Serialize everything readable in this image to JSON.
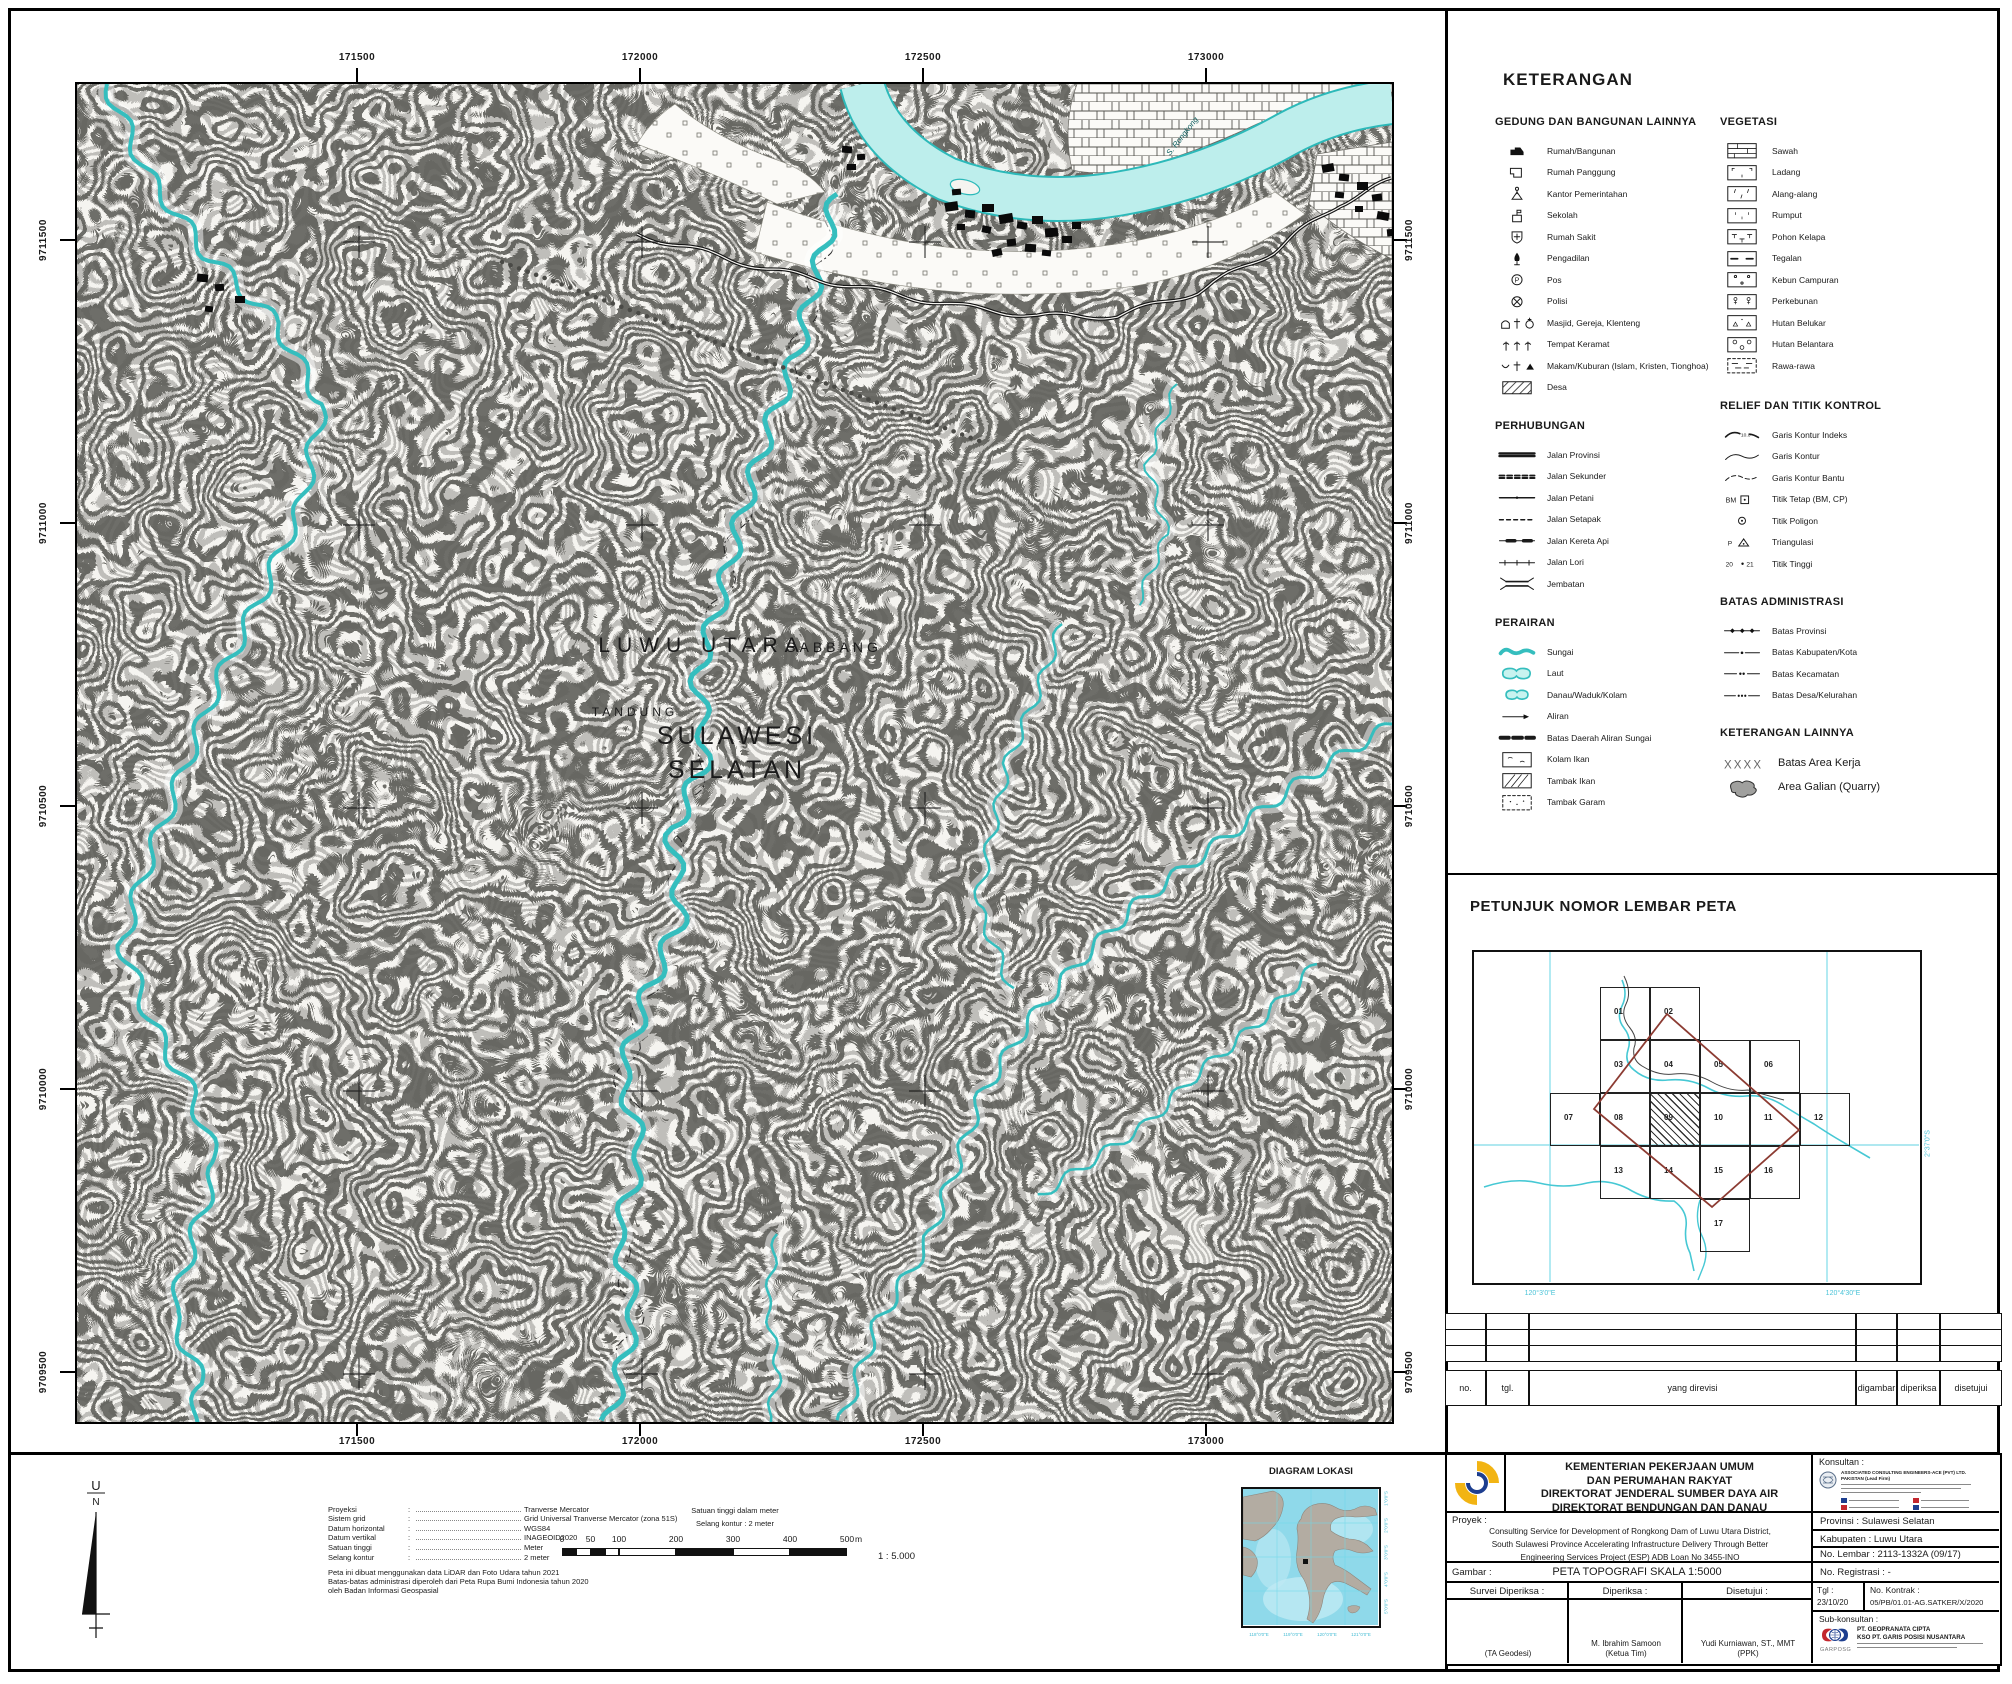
{
  "colors": {
    "water": "#35bebe",
    "water_fill": "#bdeeec",
    "cyan_label": "#4cc4d8",
    "diamond": "#8c3b32",
    "logo_yellow": "#f2b413",
    "logo_blue": "#1d3e8f",
    "logo_red": "#c3272e"
  },
  "map": {
    "top_labels": [
      "171500",
      "172000",
      "172500",
      "173000"
    ],
    "bottom_labels": [
      "171500",
      "172000",
      "172500",
      "173000"
    ],
    "left_labels": [
      "9711500",
      "9711000",
      "9710500",
      "9710000",
      "9709500"
    ],
    "right_labels": [
      "9711500",
      "9711000",
      "9710500",
      "9710000",
      "9709500"
    ],
    "place_labels": {
      "region_top": "LUWU UTARA",
      "village": "SABBANG",
      "village2": "TANDUNG",
      "region_main_1": "SULAWESI",
      "region_main_2": "SELATAN",
      "river_name": "S. Rongkong"
    }
  },
  "legend": {
    "title": "KETERANGAN",
    "sections": [
      {
        "title": "GEDUNG DAN BANGUNAN LAINNYA",
        "items": [
          {
            "label": "Rumah/Bangunan",
            "sym": "house",
            "icon": "house-icon"
          },
          {
            "label": "Rumah Panggung",
            "sym": "stilt",
            "icon": "stilt-house-icon"
          },
          {
            "label": "Kantor Pemerintahan",
            "sym": "office",
            "icon": "government-office-icon"
          },
          {
            "label": "Sekolah",
            "sym": "school",
            "icon": "school-icon"
          },
          {
            "label": "Rumah Sakit",
            "sym": "hospital",
            "icon": "hospital-icon"
          },
          {
            "label": "Pengadilan",
            "sym": "court",
            "icon": "courthouse-icon"
          },
          {
            "label": "Pos",
            "sym": "post",
            "icon": "post-office-icon"
          },
          {
            "label": "Polisi",
            "sym": "police",
            "icon": "police-icon"
          },
          {
            "label": "Masjid, Gereja, Klenteng",
            "sym": "worship",
            "icon": "worship-places-icon"
          },
          {
            "label": "Tempat Keramat",
            "sym": "sacred",
            "icon": "sacred-place-icon"
          },
          {
            "label": "Makam/Kuburan (Islam, Kristen, Tionghoa)",
            "sym": "grave",
            "icon": "cemetery-icon"
          },
          {
            "label": "Desa",
            "sym": "desa",
            "icon": "village-area-icon"
          }
        ]
      },
      {
        "title": "PERHUBUNGAN",
        "items": [
          {
            "label": "Jalan Provinsi",
            "sym": "road-prov",
            "icon": "provincial-road-icon"
          },
          {
            "label": "Jalan Sekunder",
            "sym": "road-sec",
            "icon": "secondary-road-icon"
          },
          {
            "label": "Jalan Petani",
            "sym": "road-farm",
            "icon": "farm-road-icon"
          },
          {
            "label": "Jalan Setapak",
            "sym": "road-path",
            "icon": "footpath-icon"
          },
          {
            "label": "Jalan Kereta Api",
            "sym": "railway",
            "icon": "railway-icon"
          },
          {
            "label": "Jalan Lori",
            "sym": "lori",
            "icon": "lori-track-icon"
          },
          {
            "label": "Jembatan",
            "sym": "bridge",
            "icon": "bridge-icon"
          }
        ]
      },
      {
        "title": "PERAIRAN",
        "items": [
          {
            "label": "Sungai",
            "sym": "river",
            "icon": "river-icon"
          },
          {
            "label": "Laut",
            "sym": "sea",
            "icon": "sea-icon"
          },
          {
            "label": "Danau/Waduk/Kolam",
            "sym": "lake",
            "icon": "lake-icon"
          },
          {
            "label": "Aliran",
            "sym": "flow",
            "icon": "flow-arrow-icon"
          },
          {
            "label": "Batas Daerah Aliran Sungai",
            "sym": "das",
            "icon": "watershed-boundary-icon"
          },
          {
            "label": "Kolam Ikan",
            "sym": "fishpond",
            "icon": "fishpond-icon"
          },
          {
            "label": "Tambak Ikan",
            "sym": "fishfarm",
            "icon": "fish-farm-icon"
          },
          {
            "label": "Tambak Garam",
            "sym": "saltpond",
            "icon": "salt-pond-icon"
          }
        ]
      },
      {
        "title": "VEGETASI",
        "items": [
          {
            "label": "Sawah",
            "sym": "sawah",
            "icon": "ricefield-icon"
          },
          {
            "label": "Ladang",
            "sym": "ladang",
            "icon": "field-icon"
          },
          {
            "label": "Alang-alang",
            "sym": "alang",
            "icon": "reed-grass-icon"
          },
          {
            "label": "Rumput",
            "sym": "rumput",
            "icon": "grass-icon"
          },
          {
            "label": "Pohon Kelapa",
            "sym": "kelapa",
            "icon": "coconut-palm-icon"
          },
          {
            "label": "Tegalan",
            "sym": "tegalan",
            "icon": "dry-field-icon"
          },
          {
            "label": "Kebun Campuran",
            "sym": "kebun",
            "icon": "mixed-garden-icon"
          },
          {
            "label": "Perkebunan",
            "sym": "perkebunan",
            "icon": "plantation-icon"
          },
          {
            "label": "Hutan Belukar",
            "sym": "belukar",
            "icon": "shrub-forest-icon"
          },
          {
            "label": "Hutan Belantara",
            "sym": "belantara",
            "icon": "wild-forest-icon"
          },
          {
            "label": "Rawa-rawa",
            "sym": "rawa",
            "icon": "swamp-icon"
          }
        ]
      },
      {
        "title": "RELIEF DAN TITIK KONTROL",
        "items": [
          {
            "label": "Garis Kontur Indeks",
            "sym": "contour-index",
            "icon": "index-contour-icon"
          },
          {
            "label": "Garis Kontur",
            "sym": "contour",
            "icon": "contour-line-icon"
          },
          {
            "label": "Garis Kontur Bantu",
            "sym": "contour-aux",
            "icon": "auxiliary-contour-icon"
          },
          {
            "label": "Titik Tetap (BM, CP)",
            "sym": "bm",
            "icon": "benchmark-point-icon"
          },
          {
            "label": "Titik Poligon",
            "sym": "poligon",
            "icon": "polygon-point-icon"
          },
          {
            "label": "Triangulasi",
            "sym": "triangulasi",
            "icon": "triangulation-icon"
          },
          {
            "label": "Titik Tinggi",
            "sym": "spot-height",
            "icon": "spot-height-icon"
          }
        ]
      },
      {
        "title": "BATAS ADMINISTRASI",
        "items": [
          {
            "label": "Batas Provinsi",
            "sym": "b-prov",
            "icon": "province-boundary-icon"
          },
          {
            "label": "Batas Kabupaten/Kota",
            "sym": "b-kab",
            "icon": "regency-boundary-icon"
          },
          {
            "label": "Batas Kecamatan",
            "sym": "b-kec",
            "icon": "district-boundary-icon"
          },
          {
            "label": "Batas Desa/Kelurahan",
            "sym": "b-desa",
            "icon": "village-boundary-icon"
          }
        ]
      },
      {
        "title": "KETERANGAN LAINNYA",
        "items": [
          {
            "label": "Batas Area Kerja",
            "sym": "xxxx",
            "icon": "work-area-boundary-icon"
          },
          {
            "label": "Area Galian (Quarry)",
            "sym": "quarry",
            "icon": "quarry-area-icon"
          }
        ]
      }
    ]
  },
  "sheet_index": {
    "title": "PETUNJUK NOMOR LEMBAR PETA",
    "highlight": "09",
    "cells": [
      {
        "n": "01",
        "c": 2,
        "r": 1
      },
      {
        "n": "02",
        "c": 3,
        "r": 1
      },
      {
        "n": "03",
        "c": 2,
        "r": 2
      },
      {
        "n": "04",
        "c": 3,
        "r": 2
      },
      {
        "n": "05",
        "c": 4,
        "r": 2
      },
      {
        "n": "06",
        "c": 5,
        "r": 2
      },
      {
        "n": "07",
        "c": 1,
        "r": 3
      },
      {
        "n": "08",
        "c": 2,
        "r": 3
      },
      {
        "n": "09",
        "c": 3,
        "r": 3
      },
      {
        "n": "10",
        "c": 4,
        "r": 3
      },
      {
        "n": "11",
        "c": 5,
        "r": 3
      },
      {
        "n": "12",
        "c": 6,
        "r": 3
      },
      {
        "n": "13",
        "c": 2,
        "r": 4
      },
      {
        "n": "14",
        "c": 3,
        "r": 4
      },
      {
        "n": "15",
        "c": 4,
        "r": 4
      },
      {
        "n": "16",
        "c": 5,
        "r": 4
      },
      {
        "n": "17",
        "c": 4,
        "r": 5
      }
    ],
    "bottom_labels": [
      "120°3'0\"E",
      "120°4'30\"E"
    ],
    "right_label": "2°37'0\"S"
  },
  "revision_table": {
    "headers": [
      "no.",
      "tgl.",
      "yang direvisi",
      "digambar",
      "diperiksa",
      "disetujui"
    ],
    "empty_rows": 3
  },
  "title_block": {
    "ministry_lines": [
      "KEMENTERIAN PEKERJAAN UMUM",
      "DAN PERUMAHAN RAKYAT",
      "DIREKTORAT JENDERAL SUMBER DAYA AIR",
      "DIREKTORAT BENDUNGAN DAN DANAU"
    ],
    "konsultan_label": "Konsultan :",
    "konsultan_line1": "ASSOCIATED CONSULTING ENGINEERS-ACE (PVT) LTD.",
    "konsultan_line2": "PAKISTAN (Lead Firm)",
    "proyek_label": "Proyek :",
    "proyek_lines": [
      "Consulting Service for Development of Rongkong Dam of Luwu Utara District,",
      "South Sulawesi Province Accelerating Infrastructure Delivery Through Better",
      "Engineering Services Project (ESP) ADB Loan No 3455-INO"
    ],
    "provinsi": "Provinsi : Sulawesi Selatan",
    "kabupaten": "Kabupaten : Luwu Utara",
    "no_lembar": "No. Lembar : 2113-1332A (09/17)",
    "gambar_label": "Gambar :",
    "gambar_value": "PETA TOPOGRAFI SKALA 1:5000",
    "no_registrasi": "No. Registrasi : -",
    "col_survei": "Survei Diperiksa :",
    "col_diperiksa": "Diperiksa :",
    "col_disetujui": "Disetujui :",
    "tgl_label": "Tgl :",
    "tgl_value": "23/10/20",
    "kontrak_label": "No. Kontrak :",
    "kontrak_value": "05/PB/01.01-AG.SATKER/X/2020",
    "sign_survei": "(TA Geodesi)",
    "sign_diperiksa_name": "M. Ibrahim Samoon",
    "sign_diperiksa_role": "(Ketua Tim)",
    "sign_disetujui_name": "Yudi Kurniawan, ST., MMT",
    "sign_disetujui_role": "(PPK)",
    "sub_label": "Sub-konsultan :",
    "sub_logo_text": "GARPOSG",
    "sub_name1": "PT. GEOPRANATA CIPTA",
    "sub_name2": "KSO PT. GARIS POSISI NUSANTARA"
  },
  "map_info": {
    "north_top": "U",
    "north_bottom": "N",
    "params": [
      {
        "label": "Proyeksi",
        "value": "Tranverse Mercator"
      },
      {
        "label": "Sistem grid",
        "value": "Grid Universal Tranverse Mercator (zona 51S)"
      },
      {
        "label": "Datum horizontal",
        "value": "WGS84"
      },
      {
        "label": "Datum vertikal",
        "value": "INAGEOID2020"
      },
      {
        "label": "Satuan tinggi",
        "value": "Meter"
      },
      {
        "label": "Selang kontur",
        "value": "2 meter"
      }
    ],
    "notes": [
      "Peta ini dibuat menggunakan data LiDAR dan Foto Udara tahun 2021",
      "Batas-batas administrasi diperoleh dari Peta Rupa Bumi Indonesia tahun 2020",
      "oleh Badan Informasi Geospasial"
    ],
    "scale_caption1": "Satuan tinggi dalam meter",
    "scale_caption2": "Selang kontur : 2 meter",
    "scale_ticks": [
      "0",
      "50",
      "100",
      "200",
      "300",
      "400",
      "500"
    ],
    "scale_unit": "m",
    "scale_ratio": "1 : 5.000"
  },
  "diagram_lokasi": {
    "title": "DIAGRAM LOKASI",
    "bottom_labels": [
      "118°0'0\"E",
      "119°0'0\"E",
      "120°0'0\"E",
      "121°0'0\"E"
    ],
    "right_labels": [
      "1°0'0\"S",
      "2°0'0\"S",
      "3°0'0\"S",
      "4°0'0\"S",
      "5°0'0\"S"
    ]
  }
}
